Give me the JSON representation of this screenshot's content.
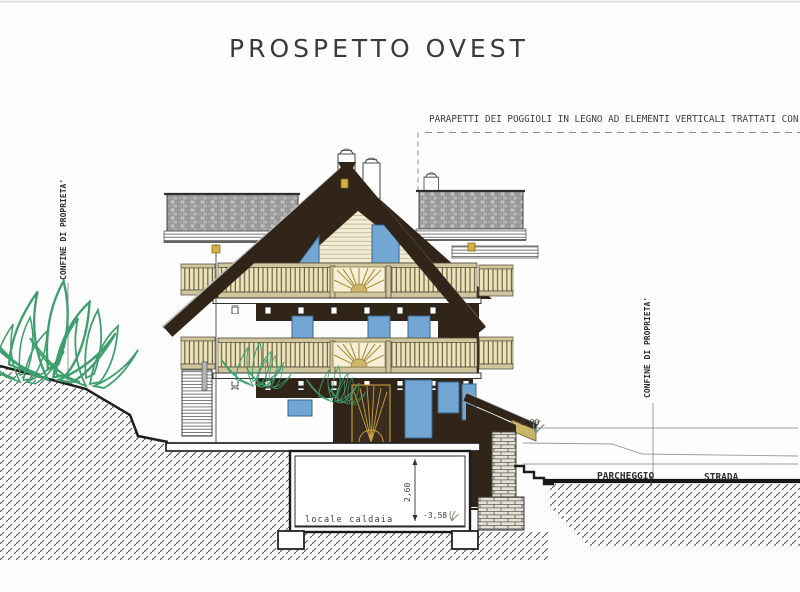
{
  "title": "PROSPETTO OVEST",
  "annotation": "PARAPETTI DEI POGGIOLI IN LEGNO AD ELEMENTI VERTICALI TRATTATI CON",
  "property_line_left": "CONFINE DI PROPRIETA'",
  "property_line_right": "CONFINE DI PROPRIETA'",
  "labels": {
    "parking": "PARCHEGGIO",
    "road": "STRADA",
    "boiler_room": "locale caldaia"
  },
  "levels": {
    "ground": "0,00",
    "basement": "-3,58",
    "basement_height": "2,60"
  },
  "colors": {
    "wood_dark": "#31251a",
    "siding_cream": "#f2ecd6",
    "railing_wood": "#ebe2ba",
    "window_blue": "#72a7d4",
    "roof_tile_grey": "#a9a9a9",
    "accent_gold": "#d7af3e",
    "vegetation_green": "#3f9e6e",
    "line_dark": "#2a2a2a"
  }
}
